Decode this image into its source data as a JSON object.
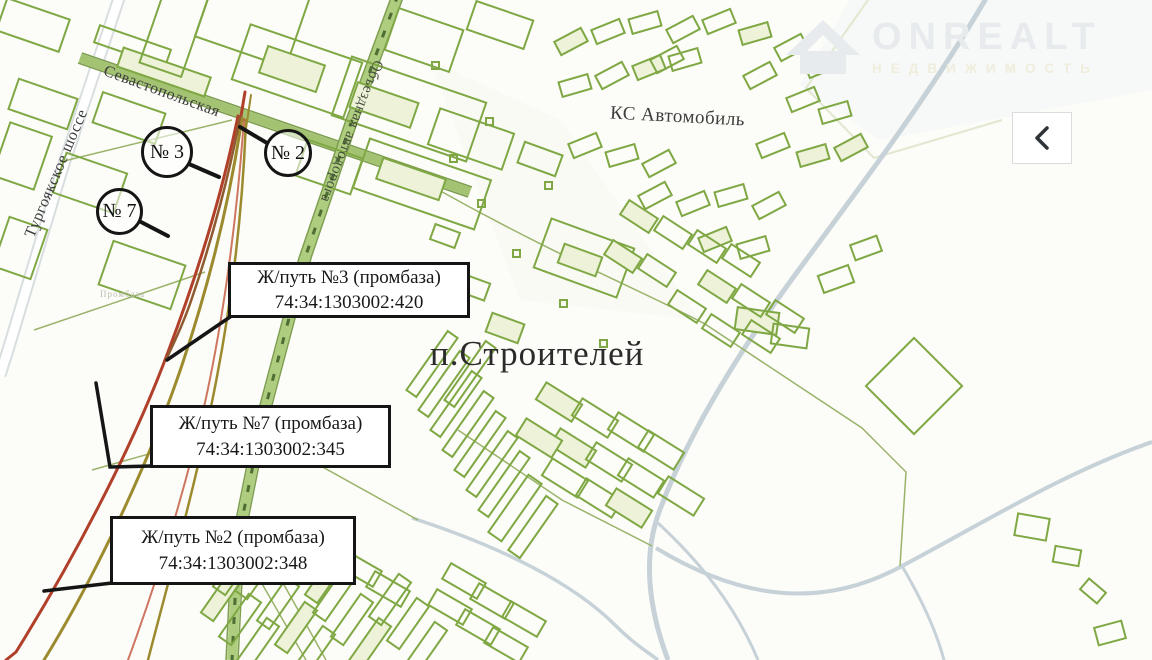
{
  "watermark": {
    "brand": "ONREALT",
    "tagline": "НЕДВИЖИМОСТЬ"
  },
  "map": {
    "streets": {
      "sevastopolskaya": "Севастопольская",
      "turgoyakskoe": "Тургоякское шоссе",
      "obyezdnaya": "Объездная автодорога"
    },
    "areas": {
      "ks_avtomobil": "КС Автомобиль",
      "p_stroiteley": "п.Строителей",
      "promzona": "Промбаза"
    },
    "markers": [
      {
        "label": "№ 3"
      },
      {
        "label": "№ 2"
      },
      {
        "label": "№ 7"
      }
    ],
    "callouts": [
      {
        "title": "Ж/путь №3 (промбаза)",
        "number": "74:34:1303002:420"
      },
      {
        "title": "Ж/путь №7 (промбаза)",
        "number": "74:34:1303002:345"
      },
      {
        "title": "Ж/путь №2 (промбаза)",
        "number": "74:34:1303002:348"
      }
    ],
    "colors": {
      "parcel_green": "#7fa844",
      "road_green": "#aecd7f",
      "road_blue": "#c6d2d8",
      "rail_red": "#b0402a",
      "rail_olive": "#9c8b2e",
      "annotation_black": "#151515"
    }
  }
}
